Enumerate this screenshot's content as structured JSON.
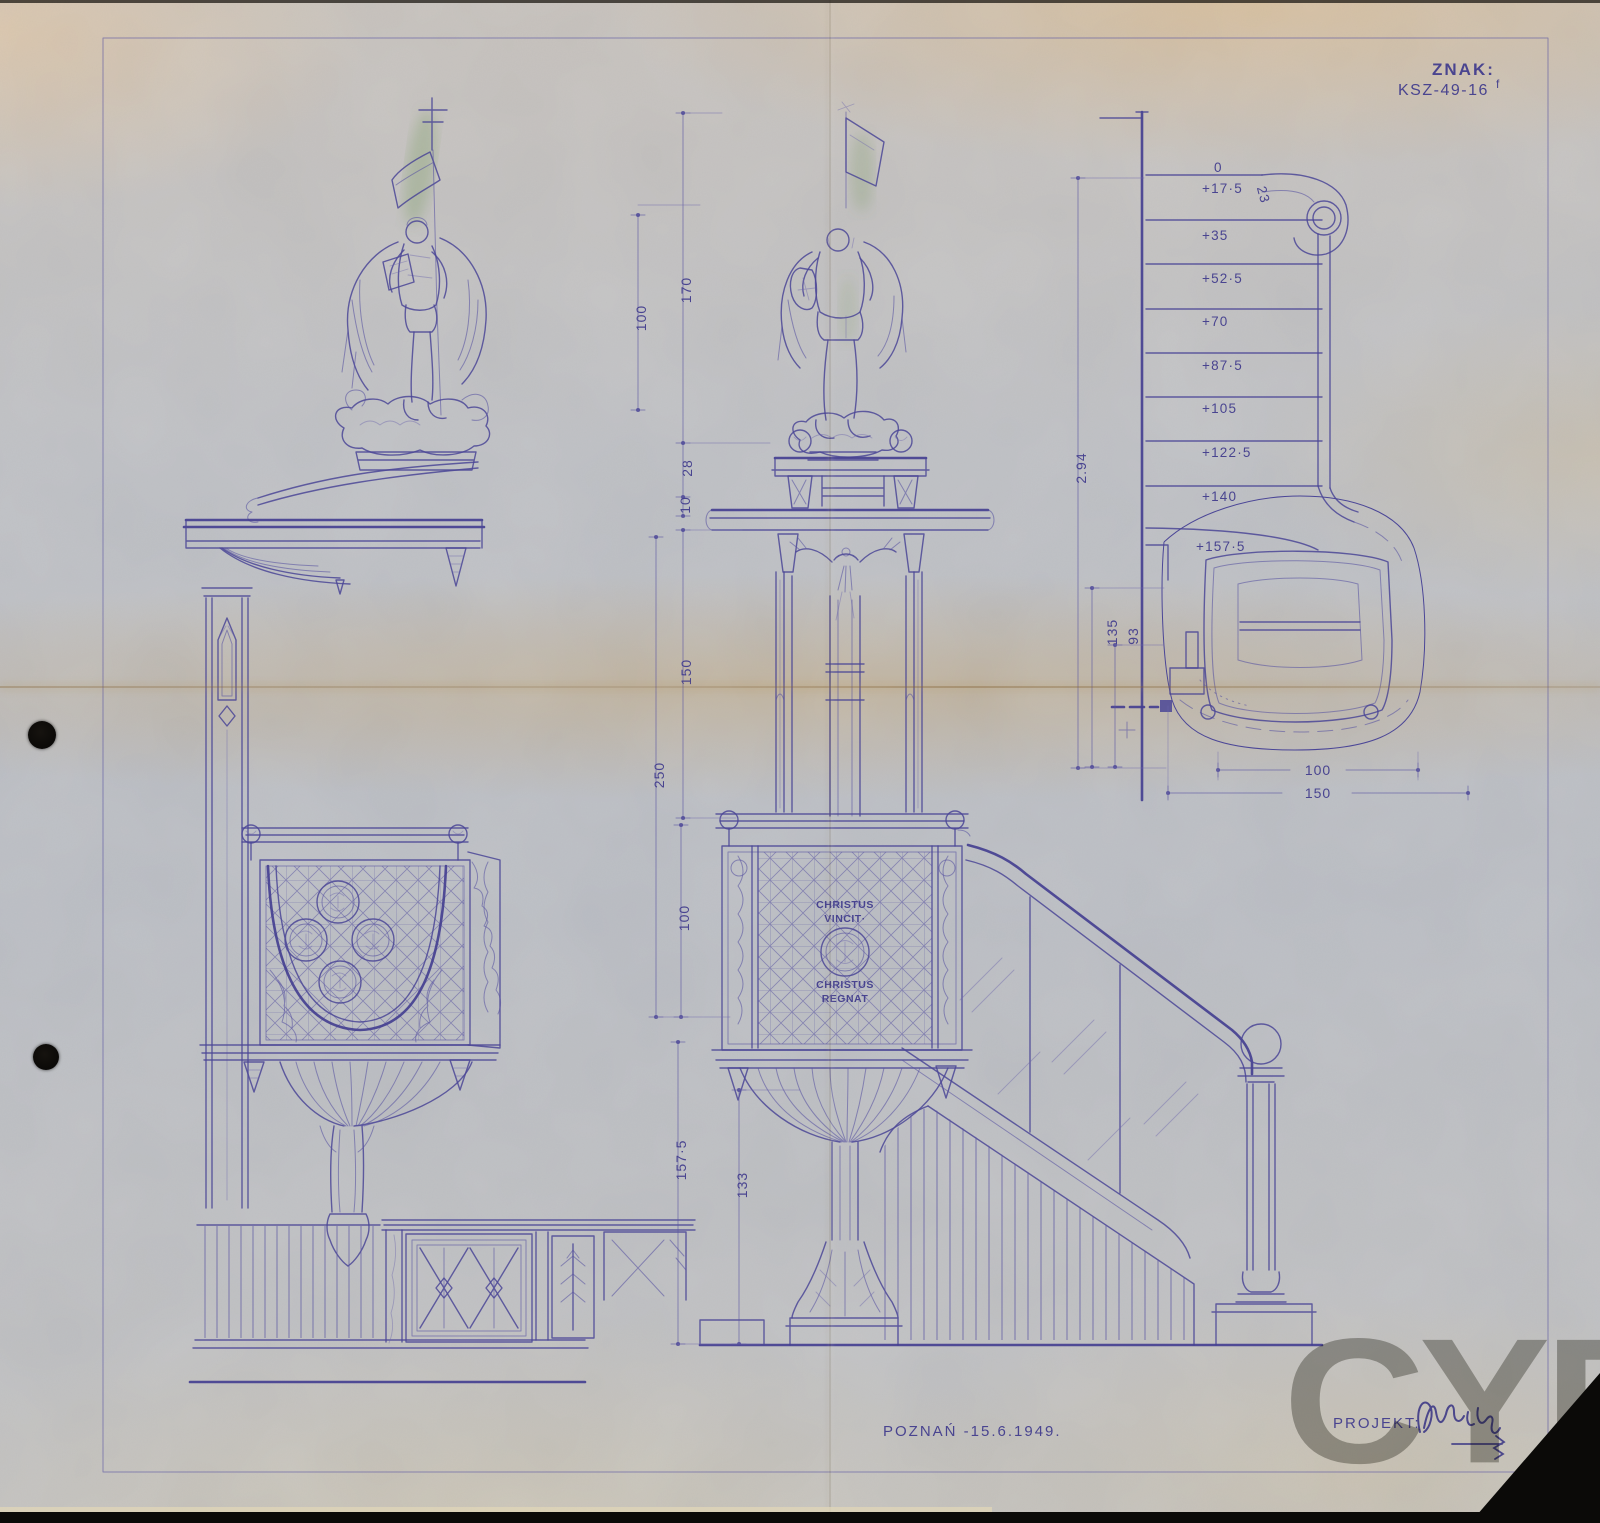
{
  "sheet": {
    "mark_label": "ZNAK:",
    "mark_code": "KSZ-49-16",
    "mark_suffix": "f",
    "place_date": "POZNAŃ -15.6.1949.",
    "author_label": "PROJEKT:",
    "watermark": "CYRYL"
  },
  "inscription": {
    "top1": "CHRISTUS",
    "top2": "VINCIT·",
    "bottom1": "CHRISTUS",
    "bottom2": "REGNAT"
  },
  "dims": {
    "front": [
      "170",
      "100",
      "28",
      "10",
      "150",
      "250",
      "100",
      "157·5",
      "133"
    ],
    "plan_levels": [
      "0",
      "+17·5",
      "+35",
      "+52·5",
      "+70",
      "+87·5",
      "+105",
      "+122·5",
      "+140",
      "+157·5"
    ],
    "tread_depth": "23",
    "total_rise": "2.94",
    "depth_a": "135",
    "depth_b": "93",
    "width_inner": "100",
    "width_outer": "150"
  },
  "colors": {
    "ink": "#4b4697",
    "paper": "#b9bcc2",
    "watermark": "#83857b"
  }
}
